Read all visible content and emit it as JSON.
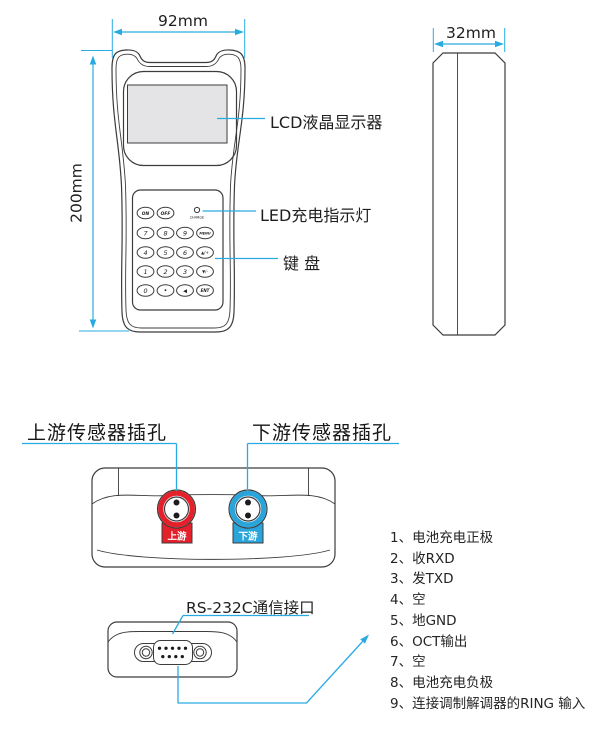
{
  "colors": {
    "accent": "#29ABE2",
    "outline": "#3C3C3C",
    "red": "#E5202A",
    "blue": "#2AA5DC",
    "lcd_fill": "#E4E4E7"
  },
  "front_view": {
    "width_dim": "92mm",
    "height_dim": "200mm",
    "labels": {
      "lcd": "LCD液晶显示器",
      "led": "LED充电指示灯",
      "keypad": "键 盘"
    },
    "keypad": {
      "charge_label": "CHARGE",
      "keys": [
        "ON",
        "OFF",
        "7",
        "8",
        "9",
        "MENU",
        "4",
        "5",
        "6",
        "▲/+",
        "1",
        "2",
        "3",
        "▼/-",
        "0",
        "·",
        "◀",
        "ENT"
      ]
    }
  },
  "side_view": {
    "width_dim": "32mm"
  },
  "top_view": {
    "upstream_label": "上游传感器插孔",
    "downstream_label": "下游传感器插孔",
    "upstream_tab": "上游",
    "downstream_tab": "下游"
  },
  "bottom_view": {
    "port_label": "RS-232C通信接口",
    "pins": [
      "1、电池充电正极",
      "2、收RXD",
      "3、发TXD",
      "4、空",
      "5、地GND",
      "6、OCT输出",
      "7、空",
      "8、电池充电负极",
      "9、连接调制解调器的RING 输入"
    ]
  }
}
